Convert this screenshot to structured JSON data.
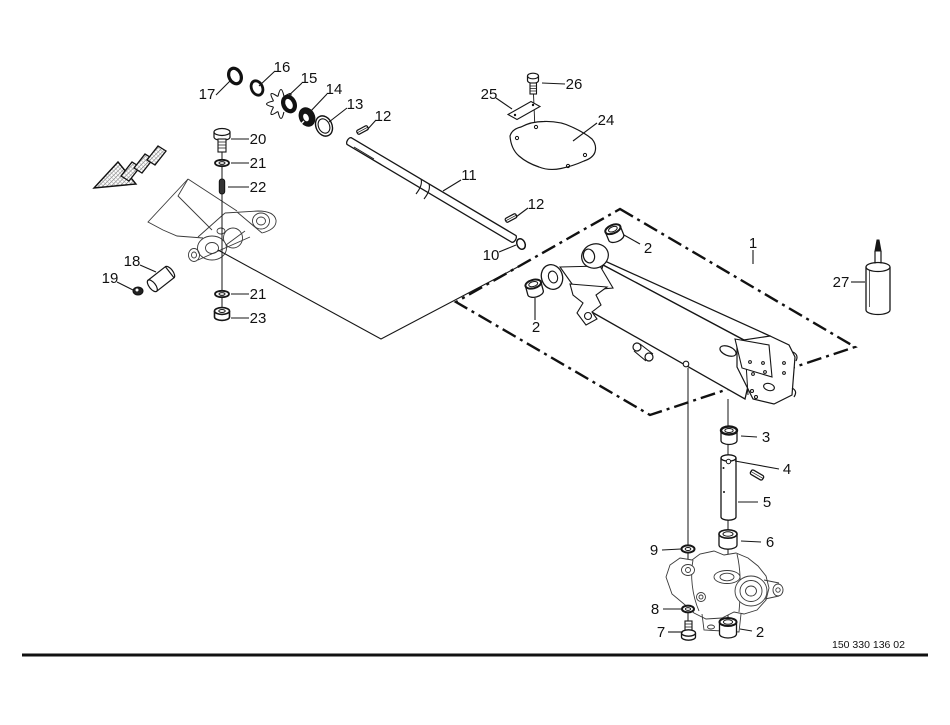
{
  "drawing": {
    "number": "150 330 136 02",
    "line_color": "#161616",
    "sketch_color": "#3a3a3a",
    "background": "#ffffff"
  },
  "legend": {
    "direction_arrow": "travel-direction-arrow-hatched"
  },
  "callouts": [
    {
      "text": "17"
    },
    {
      "text": "16"
    },
    {
      "text": "15"
    },
    {
      "text": "14"
    },
    {
      "text": "13"
    },
    {
      "text": "12"
    },
    {
      "text": "11"
    },
    {
      "text": "12"
    },
    {
      "text": "10"
    },
    {
      "text": "20"
    },
    {
      "text": "21"
    },
    {
      "text": "22"
    },
    {
      "text": "18"
    },
    {
      "text": "19"
    },
    {
      "text": "21"
    },
    {
      "text": "23"
    },
    {
      "text": "26"
    },
    {
      "text": "25"
    },
    {
      "text": "24"
    },
    {
      "text": "1"
    },
    {
      "text": "27"
    },
    {
      "text": "2"
    },
    {
      "text": "2"
    },
    {
      "text": "3"
    },
    {
      "text": "4"
    },
    {
      "text": "5"
    },
    {
      "text": "6"
    },
    {
      "text": "9"
    },
    {
      "text": "8"
    },
    {
      "text": "7"
    },
    {
      "text": "2"
    }
  ]
}
